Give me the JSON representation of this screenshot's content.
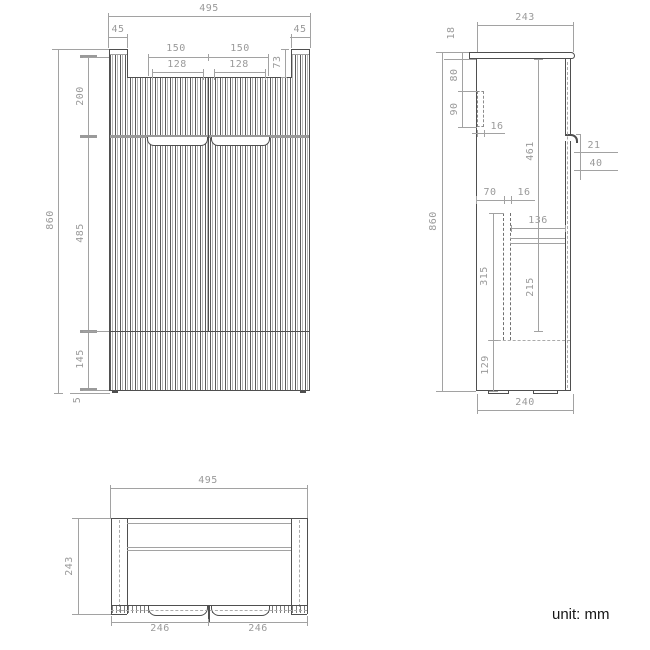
{
  "unit_label": "unit: mm",
  "front_view": {
    "width": "495",
    "side_l": "45",
    "side_r": "45",
    "groove_l": "150",
    "groove_r": "150",
    "inner_l": "128",
    "inner_r": "128",
    "recess": "73",
    "height": "860",
    "top": "200",
    "middle": "485",
    "bottom": "145",
    "foot": "5"
  },
  "side_view": {
    "depth": "243",
    "top_thick": "18",
    "bracket_offset": "80",
    "bracket_h": "90",
    "bracket_w": "16",
    "door_h": "461",
    "height": "860",
    "handle_d": "21",
    "handle_h": "40",
    "rail_offset": "70",
    "rail_w": "16",
    "inner_d": "136",
    "drawer_h": "315",
    "inner_h": "215",
    "bottom_h": "129",
    "base_depth": "240"
  },
  "bottom_view": {
    "width": "495",
    "depth": "243",
    "door_l": "246",
    "door_r": "246"
  }
}
